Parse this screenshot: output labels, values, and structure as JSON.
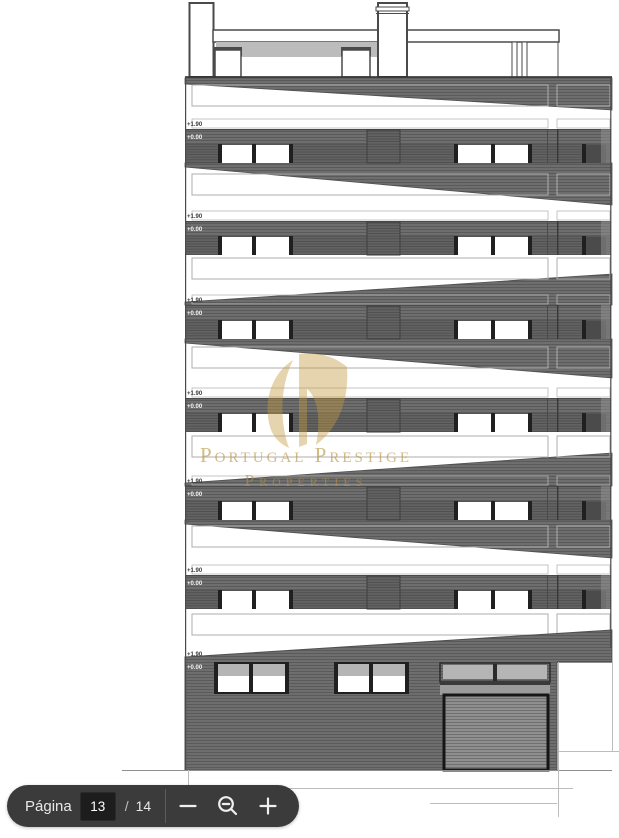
{
  "toolbar": {
    "page_label": "Página",
    "current_page": "13",
    "page_separator": "/",
    "total_pages": "14"
  },
  "watermark": {
    "line1": "Portugal Prestige",
    "line2": "Properties"
  },
  "drawing": {
    "floors": [
      {
        "upper": "+1.90",
        "lower": "+0.00"
      },
      {
        "upper": "+1.90",
        "lower": "+0.00"
      },
      {
        "upper": "+1.90",
        "lower": "+0.00"
      },
      {
        "upper": "+1.90",
        "lower": "+0.00"
      },
      {
        "upper": "+1.90",
        "lower": "+0.00"
      },
      {
        "upper": "+1.90",
        "lower": "+0.00"
      },
      {
        "upper": "+1.90",
        "lower": "+0.00"
      }
    ]
  },
  "colors": {
    "facade_gray": "#6E6E6E",
    "panel_light": "#B5B5B5",
    "frame_dark": "#202020",
    "watermark_gold": "#B8933D",
    "toolbar_bg": "#3B3B3B"
  }
}
